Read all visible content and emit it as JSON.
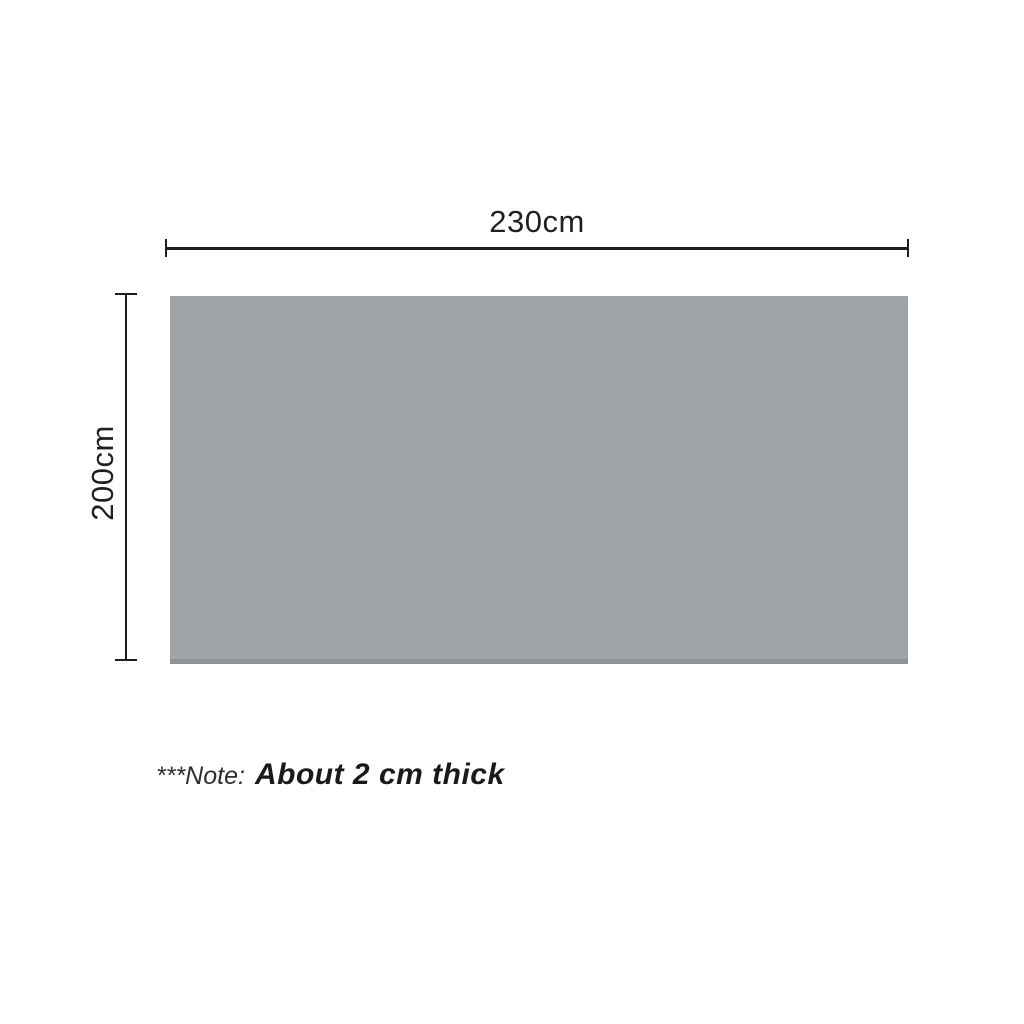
{
  "diagram": {
    "type": "product-dimension-diagram",
    "width_dimension": {
      "label": "230cm"
    },
    "height_dimension": {
      "label": "200cm"
    },
    "note": {
      "prefix": "***Note:",
      "text": "About 2 cm thick"
    },
    "colors": {
      "background": "#ffffff",
      "panel_fill": "#a1a5a8",
      "panel_bottom_edge": "#8f9396",
      "dimension_line": "#1d1d1b",
      "text": "#231f20"
    }
  }
}
